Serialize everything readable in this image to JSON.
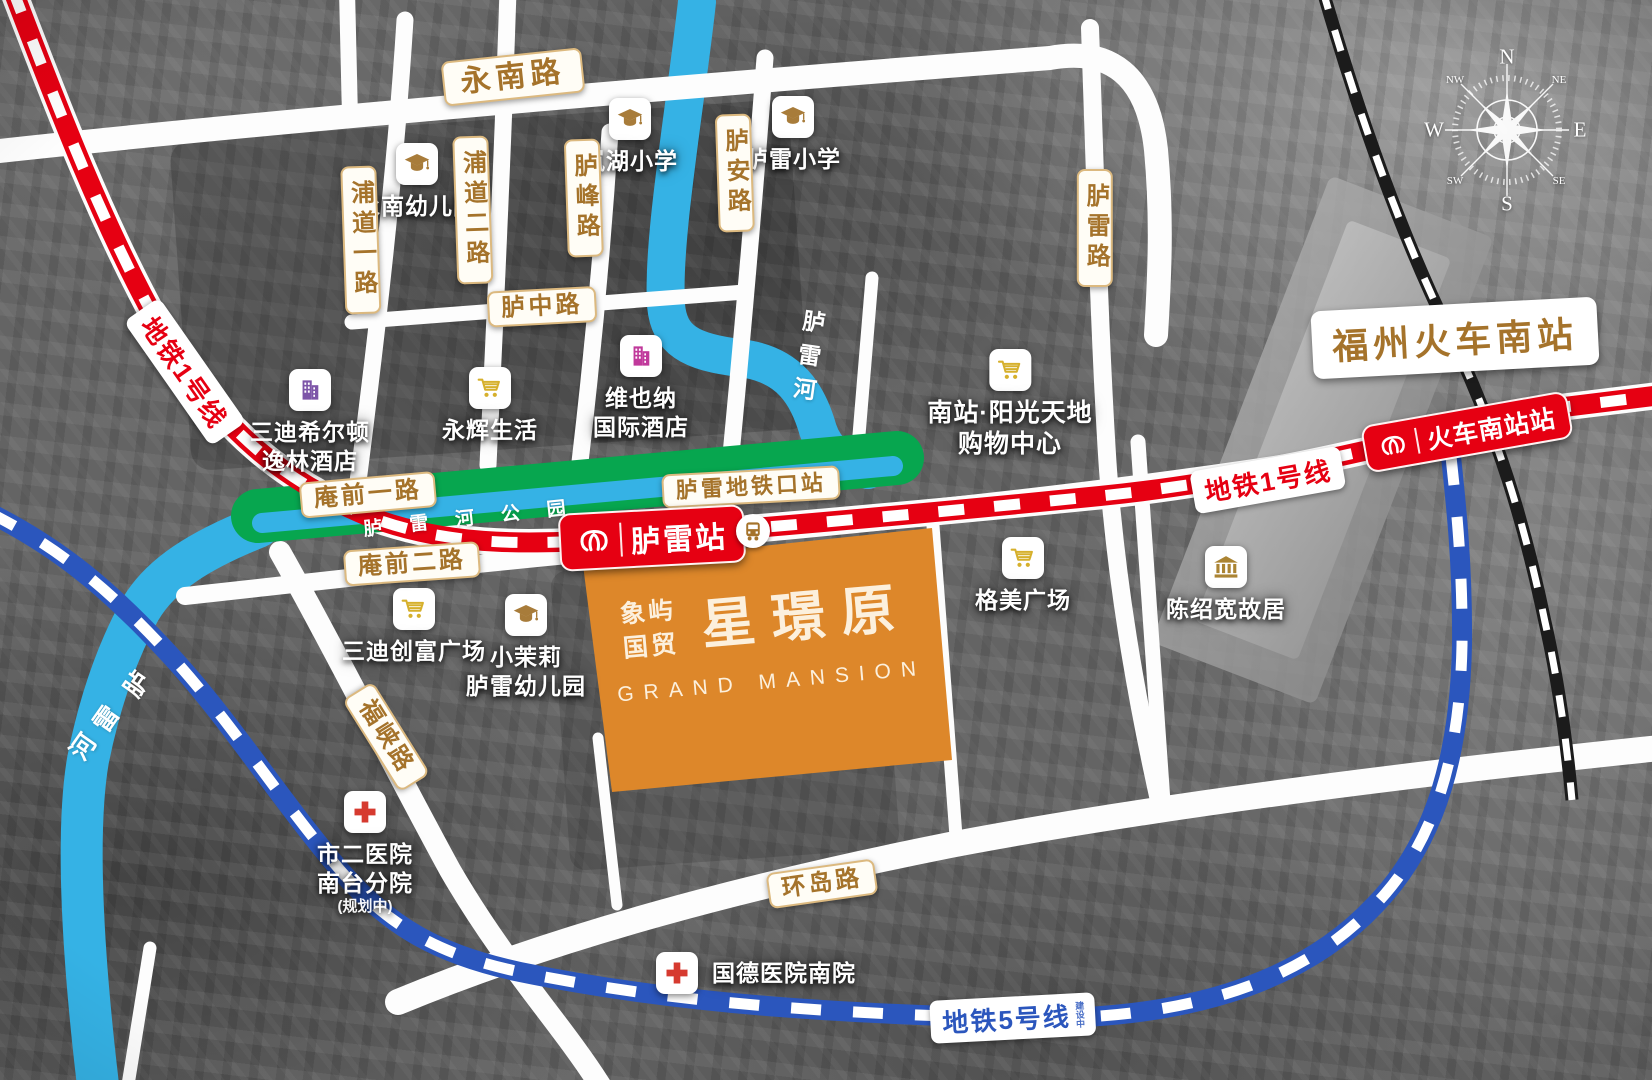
{
  "colors": {
    "red": "#e60012",
    "blue5": "#2b56bd",
    "river": "#35b2e5",
    "park": "#07a64f",
    "orange": "#dd872a",
    "gold": "#a5732b",
    "goldborder": "#dcb97f"
  },
  "icons": {
    "school": "graduation-cap-icon",
    "shopping": "cart-icon",
    "hotel": "building-icon",
    "hospital": "red-cross-icon",
    "museum": "classical-building-icon",
    "bus": "bus-icon",
    "metro": "metro-logo-icon",
    "compass": "compass-rose"
  },
  "compass": {
    "n": "N",
    "e": "E",
    "s": "S",
    "w": "W",
    "nw": "NW",
    "ne": "NE",
    "sw": "SW",
    "se": "SE"
  },
  "roads": {
    "yongnan": "永南路",
    "pudao1": "浦道一路",
    "pudao2": "浦道二路",
    "lufeng": "胪峰路",
    "luan": "胪安路",
    "lulei": "胪雷路",
    "luzhong": "胪中路",
    "anqian1": "庵前一路",
    "anqian2": "庵前二路",
    "fuxia": "福峡路",
    "huandao": "环岛路"
  },
  "transit": {
    "line1": "地铁1号线",
    "line5": "地铁5号线",
    "line5_note": "建设中",
    "station_lulei": "胪雷站",
    "station_south": "火车南站站",
    "stop_metro_exit": "胪雷地铁口站",
    "railway_station": "福州火车南站"
  },
  "water": {
    "river": "胪雷河",
    "river_c1": "胪",
    "river_c2": "雷",
    "river_c3": "河",
    "park": "胪雷河公园"
  },
  "pois": {
    "yongnan_kid": {
      "name": "永南幼儿园"
    },
    "lanhu": {
      "name": "岚湖小学"
    },
    "lulei_school": {
      "name": "胪雷小学"
    },
    "hilton": {
      "line1": "三迪希尔顿",
      "line2": "逸林酒店"
    },
    "yonghui": {
      "name": "永辉生活"
    },
    "vienna": {
      "line1": "维也纳",
      "line2": "国际酒店"
    },
    "sunshine": {
      "line1": "南站·阳光天地",
      "line2": "购物中心"
    },
    "sandi": {
      "name": "三迪创富广场"
    },
    "jasmine": {
      "line1": "小茉莉",
      "line2": "胪雷幼儿园"
    },
    "gemei": {
      "name": "格美广场"
    },
    "chen": {
      "name": "陈绍宽故居"
    },
    "hospital2": {
      "line1": "市二医院",
      "line2": "南台分院",
      "note": "(规划中)"
    },
    "guode": {
      "name": "国德医院南院"
    }
  },
  "property": {
    "brand1": "象屿",
    "brand2": "国贸",
    "name": "星璟原",
    "en": "GRAND MANSION"
  }
}
